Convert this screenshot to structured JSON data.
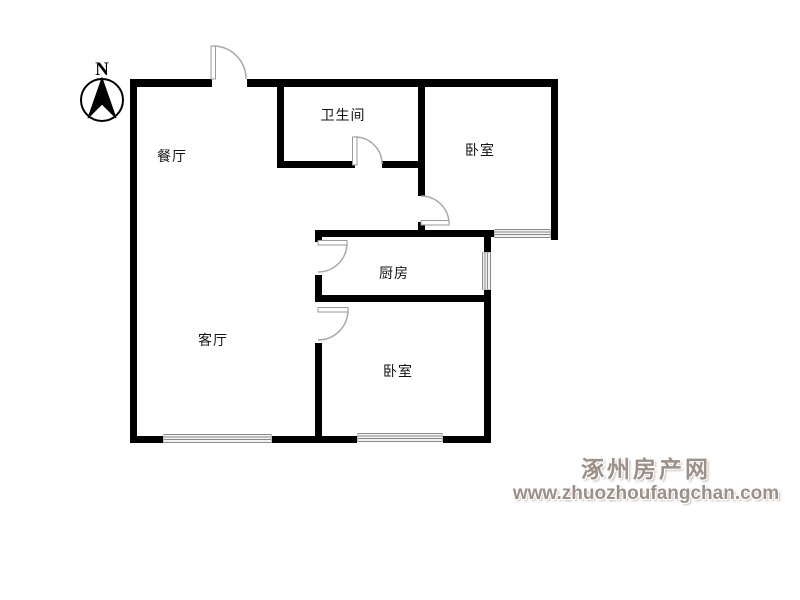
{
  "plan_title": "两室一厅户型图",
  "compass": {
    "north_label": "N"
  },
  "rooms": {
    "dining": {
      "label": "餐厅"
    },
    "bathroom": {
      "label": "卫生间"
    },
    "bedroom_top": {
      "label": "卧室"
    },
    "kitchen": {
      "label": "厨房"
    },
    "living": {
      "label": "客厅"
    },
    "bedroom_bottom": {
      "label": "卧室"
    }
  },
  "watermark": {
    "site_name": "涿州房产网",
    "site_url": "www.zhuozhoufangchan.com"
  },
  "colors": {
    "wall": "#000000",
    "door_arc": "#aaaaaa",
    "door_panel_stroke": "#999999",
    "window_line": "#8a8a8a",
    "watermark_text": "#9c9089",
    "label_text": "#141414"
  }
}
